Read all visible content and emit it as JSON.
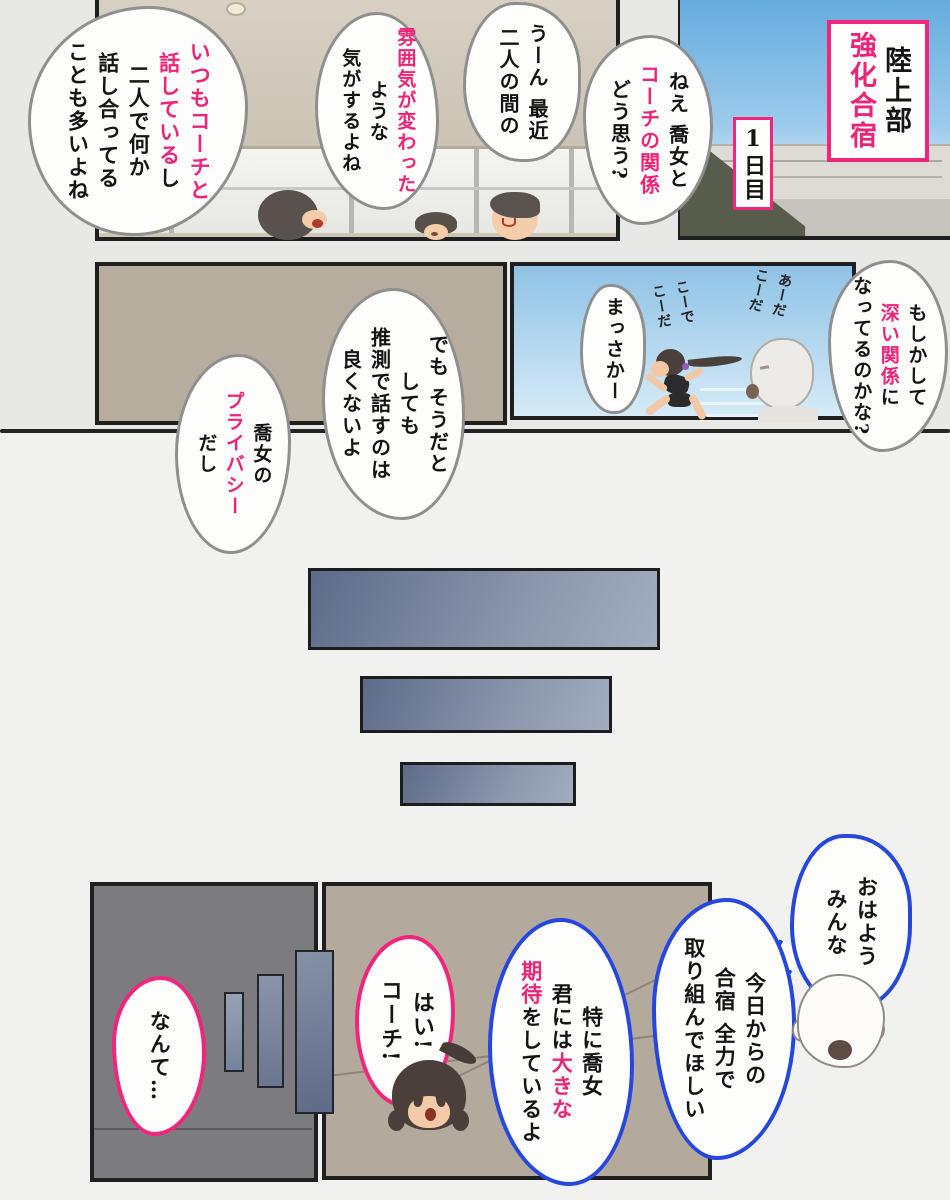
{
  "title": {
    "line_black": "陸上部",
    "line_pink": "強化合宿",
    "day": "1日目"
  },
  "bubbles": {
    "ask": {
      "c1": "ねえ 喬女と",
      "c2": "コーチの関係",
      "c3": "どう思う?"
    },
    "hmm": {
      "c1": "うーん 最近",
      "c2": "二人の間の"
    },
    "mood": {
      "c1": "雰囲気が変わった",
      "c2": "ような",
      "c3": "気がするよね"
    },
    "always": {
      "c1": "いつもコーチと",
      "c2a": "話している",
      "c2b": "し",
      "c3": "二人で何か",
      "c4": "話し合ってる",
      "c5": "ことも多いよね"
    },
    "maybe": {
      "c1": "もしかして",
      "c2a": "深い関係",
      "c2b": "に",
      "c3": "なってるのかな?"
    },
    "noway": {
      "c1": "まっさかー"
    },
    "but": {
      "c1": "でも そうだと",
      "c2": "しても",
      "c3": "推測で話すのは",
      "c4": "良くないよ"
    },
    "privacy": {
      "c1": "喬女の",
      "c2": "プライバシー",
      "c3": "だし"
    },
    "morning": {
      "c1": "おはよう",
      "c2": "みんな"
    },
    "today": {
      "c1": "今日からの",
      "c2": "合宿 全力で",
      "c3": "取り組んでほしい"
    },
    "expect": {
      "c1": "特に喬女",
      "c2a": "君には",
      "c2b": "大きな",
      "c3a": "期待",
      "c3b": "をしているよ"
    },
    "reply": {
      "c1": "はい!",
      "c2": "コーチ!"
    },
    "aside": {
      "c1": "なんて…"
    }
  },
  "sfx": {
    "r1": "あーだ",
    "r2": "こーだ",
    "l1": "こーで",
    "l2": "こーだ"
  },
  "colors": {
    "accent_pink": "#ee2377",
    "bubble_blue": "#2547dd",
    "bubble_outline_gray": "#8f8f8f",
    "sky_top": "#63aadd",
    "panel_beige": "#b6ad9f",
    "panel_dark_gray": "#7c7c80"
  }
}
